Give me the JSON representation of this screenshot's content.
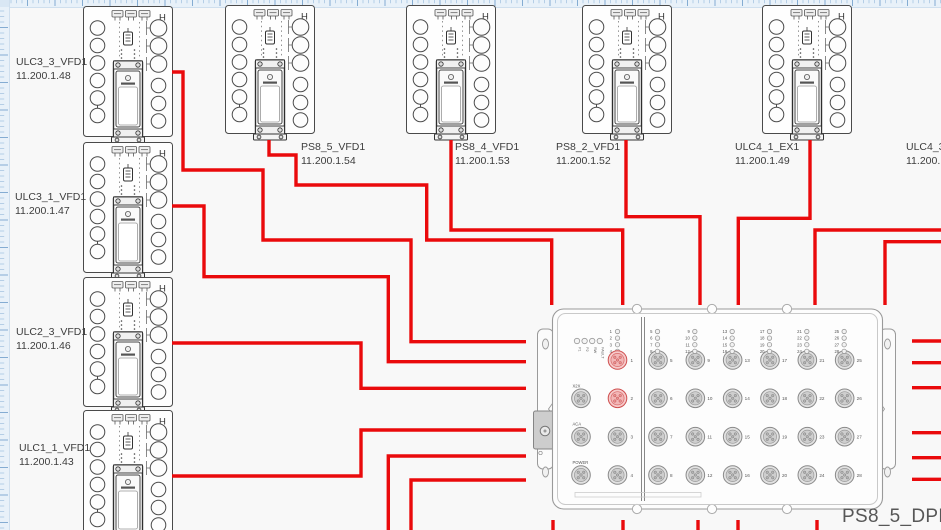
{
  "canvas": {
    "width": 941,
    "height": 530,
    "background": "#f8f8f8",
    "wire_color": "#ea0a0c",
    "ruler_bg": "#e8f1f9",
    "ruler_tick_minor": "#b5cee6",
    "ruler_tick_major": "#84acd2",
    "port_highlight": "#f2b6b6"
  },
  "devices": [
    {
      "name": "ULC3_3_VFD1",
      "ip": "11.200.1.48",
      "x": 83,
      "y": 6,
      "h": 130,
      "label_x": 16,
      "label_y": 56
    },
    {
      "name": "ULC3_1_VFD1",
      "ip": "11.200.1.47",
      "x": 83,
      "y": 142,
      "h": 130,
      "label_x": 15,
      "label_y": 191
    },
    {
      "name": "ULC2_3_VFD1",
      "ip": "11.200.1.46",
      "x": 83,
      "y": 277,
      "h": 129,
      "label_x": 16,
      "label_y": 326
    },
    {
      "name": "ULC1_1_VFD1",
      "ip": "11.200.1.43",
      "x": 83,
      "y": 410,
      "h": 130,
      "label_x": 19,
      "label_y": 442
    },
    {
      "name": "PS8_5_VFD1",
      "ip": "11.200.1.54",
      "x": 225,
      "y": 5,
      "h": 128,
      "label_x": 301,
      "label_y": 141
    },
    {
      "name": "PS8_4_VFD1",
      "ip": "11.200.1.53",
      "x": 406,
      "y": 5,
      "h": 128,
      "label_x": 455,
      "label_y": 141
    },
    {
      "name": "PS8_2_VFD1",
      "ip": "11.200.1.52",
      "x": 582,
      "y": 5,
      "h": 128,
      "label_x": 556,
      "label_y": 141
    },
    {
      "name": "ULC4_1_EX1",
      "ip": "11.200.1.49",
      "x": 762,
      "y": 5,
      "h": 128,
      "label_x": 735,
      "label_y": 141
    },
    {
      "name": "ULC4_3_",
      "ip": "11.200.1",
      "x": 958,
      "y": 5,
      "h": 128,
      "label_x": 906,
      "label_y": 141
    }
  ],
  "dpm": {
    "name": "PS8_5_DPM1",
    "label_x": 842,
    "label_y": 506,
    "status_leds": [
      "P1",
      "P2",
      "RW",
      "FAULT"
    ],
    "left_led_numbers": [
      "1",
      "2",
      "3",
      "4"
    ],
    "aux_ports": [
      {
        "label": "X2X"
      },
      {
        "label": "ACA"
      },
      {
        "label": "POWER"
      }
    ],
    "numbered_ports": [
      {
        "n": "1",
        "active": true
      },
      {
        "n": "2",
        "active": true
      },
      {
        "n": "3",
        "active": false
      },
      {
        "n": "4",
        "active": false
      }
    ],
    "port_columns": [
      [
        "5",
        "6",
        "7",
        "8"
      ],
      [
        "9",
        "10",
        "11",
        "12"
      ],
      [
        "13",
        "14",
        "15",
        "16"
      ],
      [
        "17",
        "18",
        "19",
        "20"
      ],
      [
        "21",
        "22",
        "23",
        "24"
      ],
      [
        "25",
        "26",
        "27",
        "28"
      ]
    ]
  },
  "wires": [
    {
      "name": "ulc3_3_vfd1-to-dpm",
      "points": [
        [
          172,
          72
        ],
        [
          183,
          72
        ],
        [
          183,
          170
        ],
        [
          263,
          170
        ],
        [
          263,
          240
        ],
        [
          411,
          240
        ],
        [
          411,
          341.7
        ],
        [
          526,
          341.7
        ]
      ]
    },
    {
      "name": "ulc3_1_vfd1-to-dpm",
      "points": [
        [
          172,
          206
        ],
        [
          204,
          206
        ],
        [
          204,
          276.7
        ],
        [
          388.3,
          276.7
        ],
        [
          388.3,
          361.7
        ],
        [
          526,
          361.7
        ]
      ]
    },
    {
      "name": "ulc2_3_vfd1-to-dpm",
      "points": [
        [
          172,
          343
        ],
        [
          361,
          343
        ],
        [
          361,
          388.3
        ],
        [
          526,
          388.3
        ]
      ]
    },
    {
      "name": "ulc1_1_vfd1-to-dpm",
      "points": [
        [
          172,
          476
        ],
        [
          361,
          476
        ],
        [
          361,
          430
        ],
        [
          526,
          430
        ]
      ]
    },
    {
      "name": "offscreen-bottom-to-dpm-left-5",
      "points": [
        [
          388.3,
          530
        ],
        [
          388.3,
          456
        ],
        [
          526,
          456
        ]
      ]
    },
    {
      "name": "offscreen-bottom-to-dpm-left-6",
      "points": [
        [
          411,
          530
        ],
        [
          411,
          480
        ],
        [
          526,
          480
        ]
      ]
    },
    {
      "name": "ps8_5_vfd1-to-dpm",
      "points": [
        [
          269,
          140
        ],
        [
          269,
          155
        ],
        [
          296,
          155
        ],
        [
          296,
          185
        ],
        [
          426.7,
          185
        ],
        [
          426.7,
          240
        ],
        [
          551.7,
          240
        ],
        [
          551.7,
          305
        ]
      ]
    },
    {
      "name": "ps8_4_vfd1-to-dpm",
      "points": [
        [
          451,
          140
        ],
        [
          451,
          230
        ],
        [
          622.7,
          230
        ],
        [
          622.7,
          305
        ]
      ]
    },
    {
      "name": "ps8_2_vfd1-to-dpm",
      "points": [
        [
          626,
          140
        ],
        [
          626,
          216.7
        ],
        [
          700,
          216.7
        ],
        [
          700,
          305
        ]
      ]
    },
    {
      "name": "ulc4_1_ex1-to-dpm",
      "points": [
        [
          810,
          140
        ],
        [
          810,
          218.3
        ],
        [
          738.3,
          218.3
        ],
        [
          738.3,
          305
        ]
      ]
    },
    {
      "name": "offscreen-right-to-dpm-top-5",
      "points": [
        [
          941,
          230
        ],
        [
          815,
          230
        ],
        [
          815,
          305
        ]
      ]
    },
    {
      "name": "offscreen-right-to-dpm-top-6",
      "points": [
        [
          941,
          241.7
        ],
        [
          885,
          241.7
        ],
        [
          885,
          305
        ]
      ]
    },
    {
      "name": "dpm-right-stub-1",
      "points": [
        [
          912,
          341
        ],
        [
          941,
          341
        ]
      ]
    },
    {
      "name": "dpm-right-stub-2",
      "points": [
        [
          912,
          362.7
        ],
        [
          941,
          362.7
        ]
      ]
    },
    {
      "name": "dpm-right-stub-3",
      "points": [
        [
          912,
          387.7
        ],
        [
          941,
          387.7
        ]
      ]
    },
    {
      "name": "dpm-right-stub-4",
      "points": [
        [
          912,
          432.7
        ],
        [
          941,
          432.7
        ]
      ]
    },
    {
      "name": "dpm-right-stub-5",
      "points": [
        [
          912,
          457.7
        ],
        [
          941,
          457.7
        ]
      ]
    },
    {
      "name": "dpm-right-stub-6",
      "points": [
        [
          912,
          479.3
        ],
        [
          941,
          479.3
        ]
      ]
    },
    {
      "name": "dpm-bottom-stub-1",
      "points": [
        [
          553,
          520
        ],
        [
          553,
          530
        ]
      ]
    },
    {
      "name": "dpm-bottom-stub-2",
      "points": [
        [
          623,
          520
        ],
        [
          623,
          530
        ]
      ]
    },
    {
      "name": "dpm-bottom-stub-3",
      "points": [
        [
          698,
          520
        ],
        [
          698,
          530
        ]
      ]
    },
    {
      "name": "dpm-bottom-stub-4",
      "points": [
        [
          738,
          520
        ],
        [
          738,
          530
        ]
      ]
    },
    {
      "name": "dpm-bottom-stub-5",
      "points": [
        [
          817,
          520
        ],
        [
          817,
          530
        ]
      ]
    }
  ]
}
